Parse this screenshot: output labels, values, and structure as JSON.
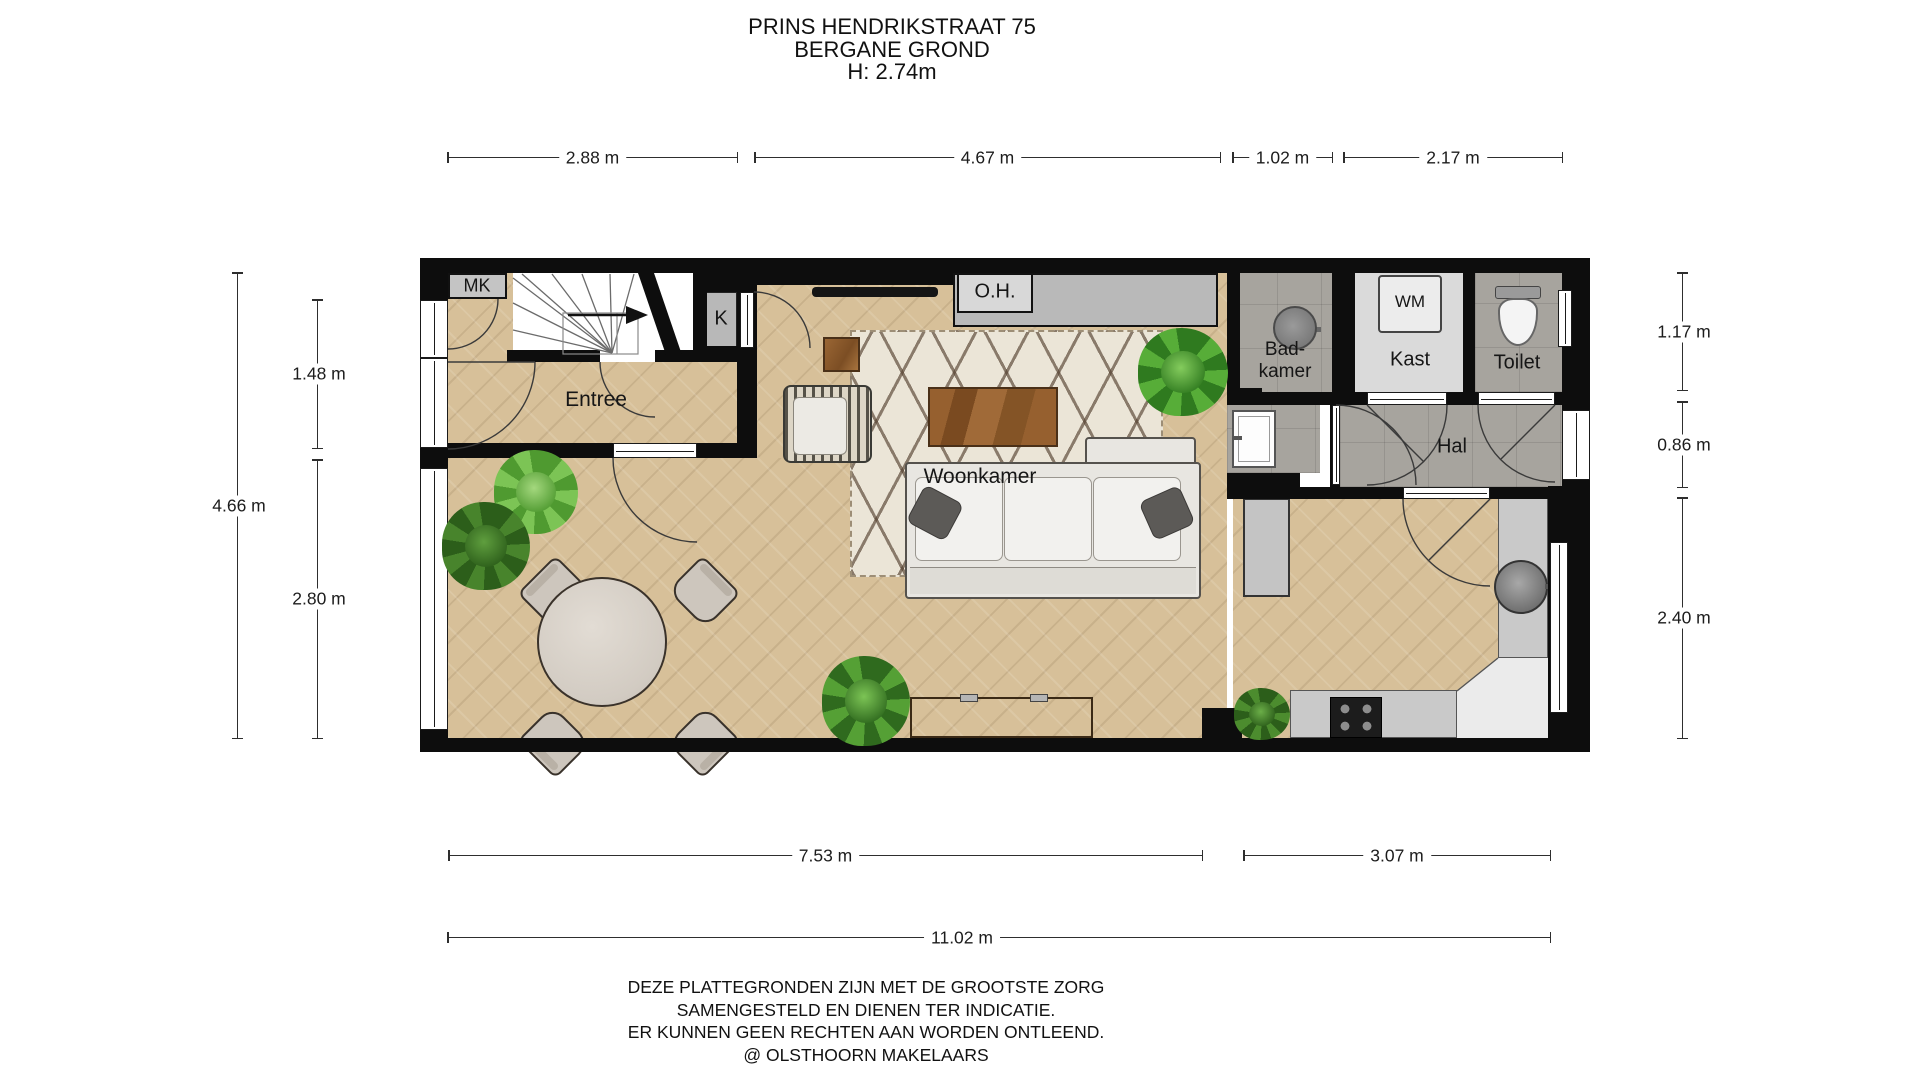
{
  "title": {
    "line1": "PRINS HENDRIKSTRAAT 75",
    "line2": "BERGANE GROND",
    "line3": "H: 2.74m"
  },
  "rooms": {
    "mk": "MK",
    "k": "K",
    "entree": "Entree",
    "woonkamer": "Woonkamer",
    "oh": "O.H.",
    "badkamer_line1": "Bad-",
    "badkamer_line2": "kamer",
    "wm": "WM",
    "kast": "Kast",
    "toilet": "Toilet",
    "hal": "Hal"
  },
  "dimensions": {
    "top": [
      {
        "label": "2.88 m"
      },
      {
        "label": "4.67 m"
      },
      {
        "label": "1.02 m"
      },
      {
        "label": "2.17 m"
      }
    ],
    "bottom": [
      {
        "label": "7.53 m"
      },
      {
        "label": "3.07 m"
      }
    ],
    "overall": {
      "label": "11.02 m"
    },
    "left": {
      "outer": {
        "label": "4.66 m"
      },
      "upper": {
        "label": "1.48 m"
      },
      "lower": {
        "label": "2.80 m"
      }
    },
    "right": {
      "upper": {
        "label": "1.17 m"
      },
      "middle": {
        "label": "0.86 m"
      },
      "lower": {
        "label": "2.40 m"
      }
    }
  },
  "footer": {
    "line1": "DEZE PLATTEGRONDEN ZIJN MET DE GROOTSTE ZORG",
    "line2": "SAMENGESTELD EN DIENEN TER INDICATIE.",
    "line3": "ER KUNNEN GEEN RECHTEN AAN WORDEN ONTLEEND.",
    "line4": "@ OLSTHOORN MAKELAARS"
  },
  "colors": {
    "wall": "#0d0d0d",
    "wood_floor": "#d7c099",
    "tile": "#a7a49e",
    "rug": "#ebe5d7",
    "rug_pattern": "#54402f",
    "counter": "#c9c9c9",
    "plant_green": "#4a8a2e"
  }
}
